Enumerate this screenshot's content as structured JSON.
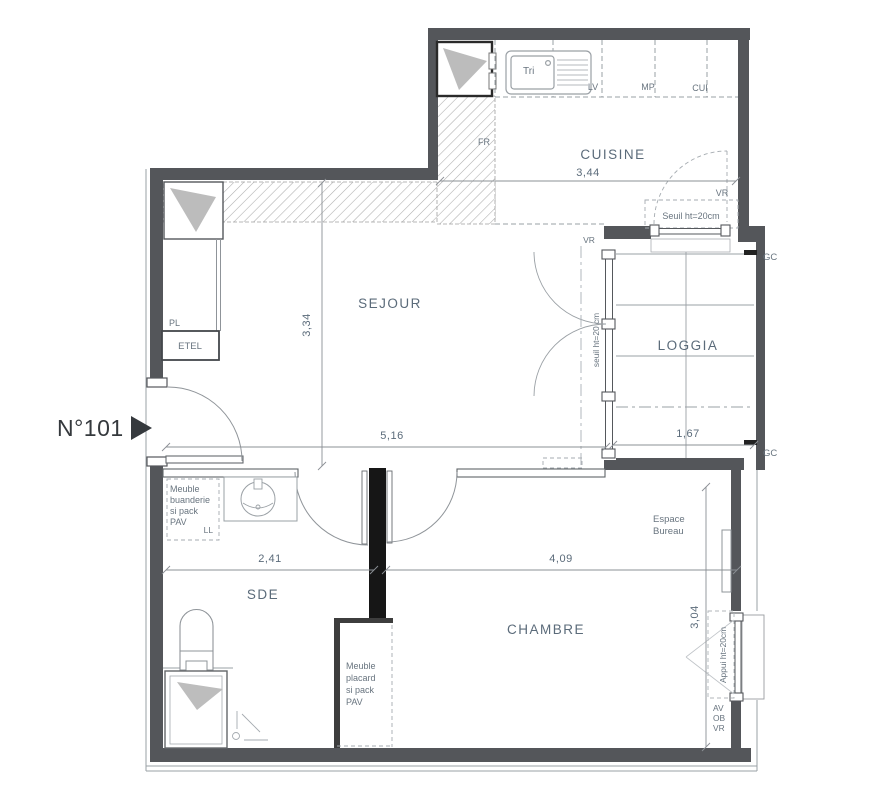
{
  "unit": {
    "number": "N°101"
  },
  "rooms": {
    "cuisine": {
      "name": "CUISINE",
      "width": "3,44"
    },
    "sejour": {
      "name": "SEJOUR",
      "depth": "3,34",
      "width": "5,16"
    },
    "loggia": {
      "name": "LOGGIA",
      "width": "1,67"
    },
    "sde": {
      "name": "SDE",
      "width": "2,41"
    },
    "chambre": {
      "name": "CHAMBRE",
      "width": "4,09",
      "depth": "3,04"
    }
  },
  "kitchen_fittings": {
    "sink": "Tri",
    "dishwasher": "LV",
    "hob": "MP",
    "oven": "CUI",
    "fridge": "FR"
  },
  "fixtures": {
    "closet": "PL",
    "etel": "ETEL",
    "washer": "LL",
    "meuble_buanderie": [
      "Meuble",
      "buanderie",
      "si pack",
      "PAV"
    ],
    "meuble_placard": [
      "Meuble",
      "placard",
      "si pack",
      "PAV"
    ],
    "espace_bureau": [
      "Espace",
      "Bureau"
    ]
  },
  "openings": {
    "vr_cuisine": "VR",
    "seuil_cuisine": "Seuil ht=20cm",
    "vr_sejour": "VR",
    "seuil_sejour": "seuil ht=20 cm",
    "appui_chambre": "Appui ht=20cm",
    "av_ob_vr": [
      "AV",
      "OB",
      "VR"
    ],
    "gc_top": "GC",
    "gc_bottom": "GC"
  },
  "colors": {
    "wall": "#54565a",
    "partition_dark": "#161616",
    "room_text": "#5b6b7a",
    "small_text": "#68747f",
    "line": "#8b9095",
    "hatch": "#adadad",
    "shaft_mark": "#bcbcbc"
  }
}
